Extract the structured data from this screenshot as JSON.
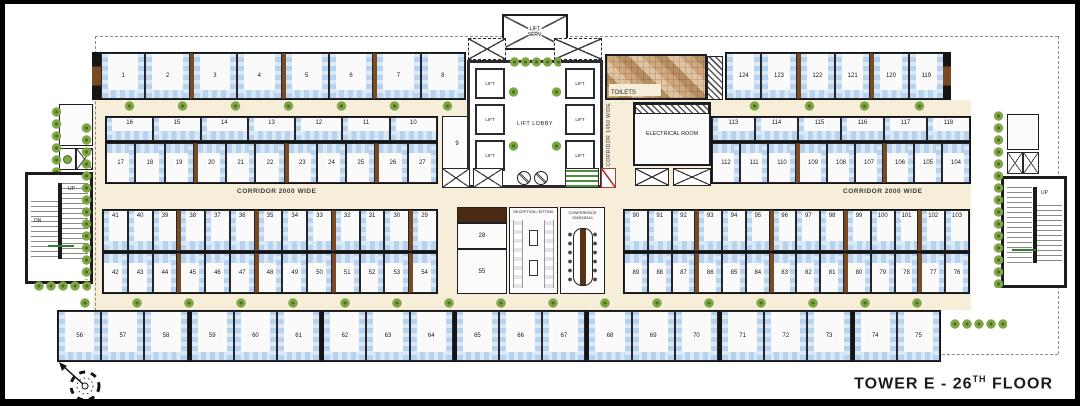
{
  "title": {
    "prefix": "TOWER E - 26",
    "sup": "TH",
    "suffix": " FLOOR"
  },
  "labels": {
    "lift_lobby": "LIFT LOBBY",
    "lift": "LIFT",
    "service_lift_line1": "LIFT",
    "service_lift_line2": "SERV.",
    "toilets": "TOILETS",
    "electrical_room": "ELECTRICAL ROOM",
    "corridor_main_left": "CORRIDOR 2000 WIDE",
    "corridor_main_right": "CORRIDOR 2000 WIDE",
    "corridor_lift": "CORRIDOR 1450 WIDE",
    "reception_line1": "RECEPTION / SITTING",
    "conference_line1": "CONFERENCE",
    "conference_line2": "2500X6244",
    "stair_down": "DN",
    "stair_up": "UP"
  },
  "units": {
    "top_left": [
      "1",
      "2",
      "3",
      "4",
      "5",
      "6",
      "7",
      "8"
    ],
    "top_right": [
      "124",
      "123",
      "122",
      "121",
      "120",
      "119"
    ],
    "mid_upper_left_top": [
      "16",
      "15",
      "14",
      "13",
      "12",
      "11",
      "10"
    ],
    "mid_upper_left_bottom": [
      "17",
      "18",
      "19",
      "20",
      "21",
      "22",
      "23",
      "24",
      "25",
      "26",
      "27"
    ],
    "unit_9": "9",
    "mid_upper_right_top": [
      "113",
      "114",
      "115",
      "116",
      "117",
      "118"
    ],
    "mid_upper_right_bottom": [
      "112",
      "111",
      "110",
      "109",
      "108",
      "107",
      "106",
      "105",
      "104"
    ],
    "mid_lower_left_top": [
      "41",
      "40",
      "39",
      "38",
      "37",
      "36",
      "35",
      "34",
      "33",
      "32",
      "31",
      "30",
      "29"
    ],
    "mid_lower_left_bottom": [
      "42",
      "43",
      "44",
      "45",
      "46",
      "47",
      "48",
      "49",
      "50",
      "51",
      "52",
      "53",
      "54"
    ],
    "center_upper": "28",
    "center_lower": "55",
    "mid_lower_right_top": [
      "90",
      "91",
      "92",
      "93",
      "94",
      "95",
      "96",
      "97",
      "98",
      "99",
      "100",
      "101",
      "102",
      "103"
    ],
    "mid_lower_right_bottom": [
      "89",
      "88",
      "87",
      "86",
      "85",
      "84",
      "83",
      "82",
      "81",
      "80",
      "79",
      "78",
      "77",
      "76"
    ],
    "bottom": [
      "56",
      "57",
      "58",
      "59",
      "60",
      "61",
      "62",
      "63",
      "64",
      "65",
      "66",
      "67",
      "68",
      "69",
      "70",
      "71",
      "72",
      "73",
      "74",
      "75"
    ]
  }
}
